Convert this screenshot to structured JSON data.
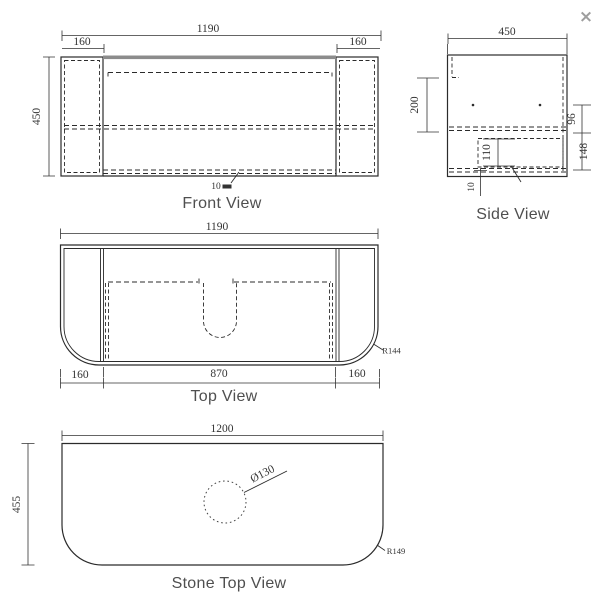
{
  "close_button": "×",
  "front_view": {
    "label": "Front View",
    "dim_width": "1190",
    "dim_end_left": "160",
    "dim_end_right": "160",
    "dim_height": "450",
    "dim_thickness": "10"
  },
  "side_view": {
    "label": "Side View",
    "dim_depth": "450",
    "dim_upper": "200",
    "dim_mid": "96",
    "dim_lower": "148",
    "dim_inner": "110",
    "dim_bottom": "10"
  },
  "top_view": {
    "label": "Top View",
    "dim_width": "1190",
    "dim_end_left": "160",
    "dim_center": "870",
    "dim_end_right": "160",
    "dim_radius": "R144"
  },
  "stone_top_view": {
    "label": "Stone Top View",
    "dim_width": "1200",
    "dim_depth": "455",
    "dim_hole": "Ø130",
    "dim_radius": "R149"
  },
  "colors": {
    "line": "#2b2b2b",
    "dim_text": "#333333",
    "label_text": "#4f4f4f",
    "top_band": "#8c8c8c",
    "close": "#9e9e9e"
  }
}
